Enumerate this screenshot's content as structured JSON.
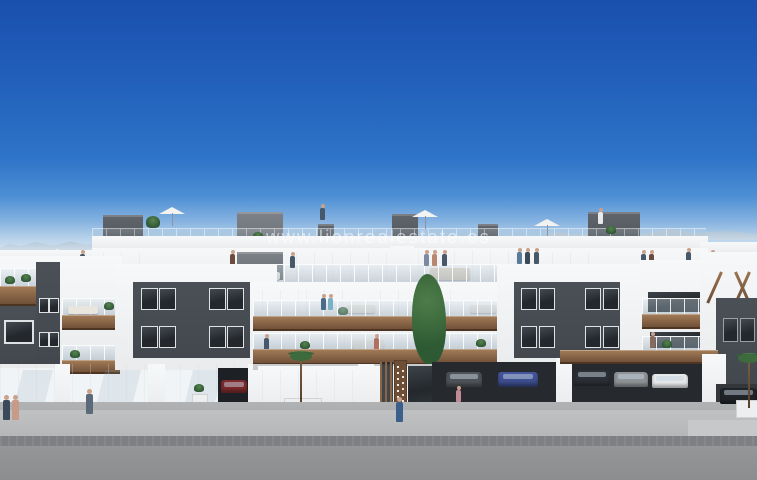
{
  "watermark": {
    "text": "www.lionrealestate.es"
  },
  "scene": {
    "type": "architectural-exterior-render",
    "subject": "modern white apartment complex with rooftop solarium terraces, wood-clad balconies, glass railings, ground-floor parking garage with cars, palm planters and street frontage under a clear blue sky",
    "palette": {
      "sky_top": "#1a4fae",
      "sky_mid": "#2e74c8",
      "sky_horizon": "#e4edf3",
      "facade_white": "#f2f3f4",
      "facade_dark": "#43484e",
      "window_glass": "#24282c",
      "wood_accent": "#8a6648",
      "foliage_green": "#3e6b3e",
      "sidewalk_gray": "#b4b6b8",
      "asphalt_gray": "#8b8d8f",
      "watermark_color": "rgba(255,255,255,0.55)"
    }
  }
}
